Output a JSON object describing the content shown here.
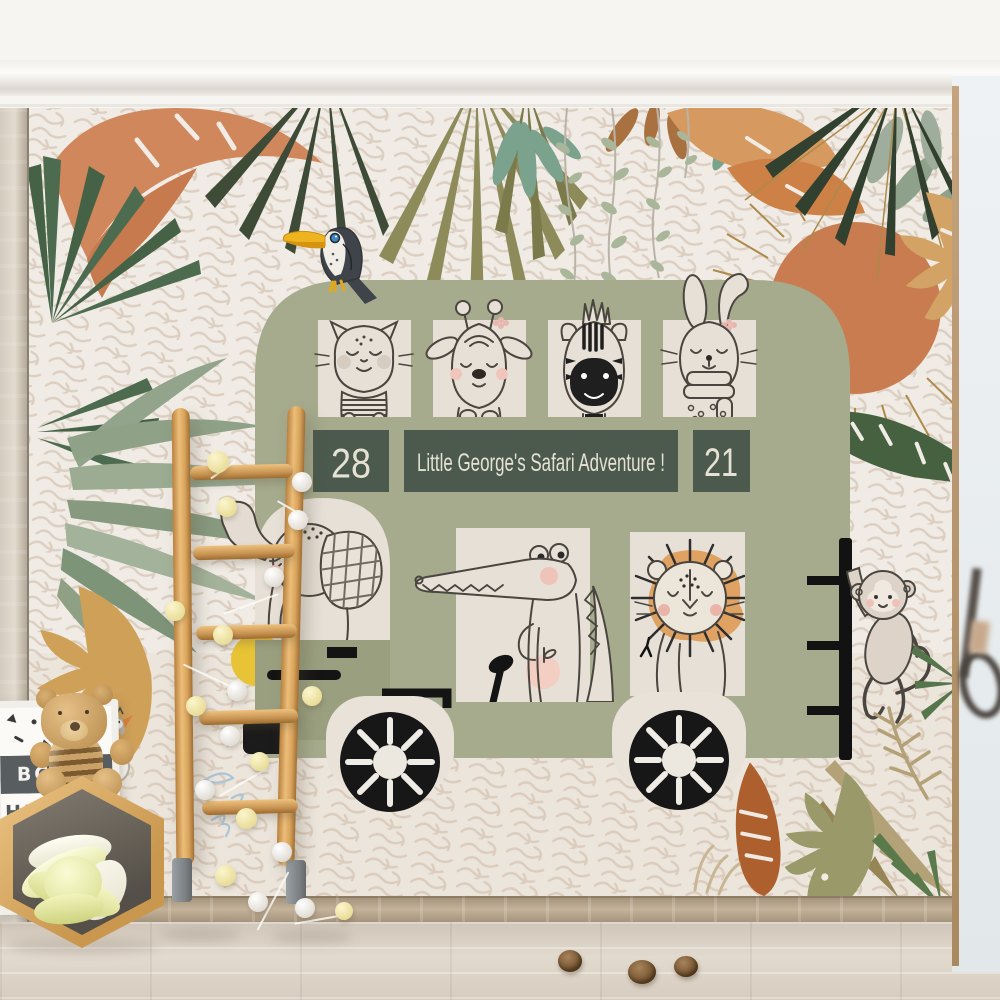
{
  "scene": {
    "bus": {
      "number_left": "28",
      "number_right": "21",
      "banner": "Little George's Safari Adventure !",
      "upper_window_animals": [
        "cat",
        "deer",
        "zebra",
        "rabbit"
      ],
      "driver": "elephant",
      "lower_window_animals": [
        "crocodile",
        "lion"
      ],
      "outside_animals": [
        "toucan",
        "monkey"
      ],
      "body_color": "#a6ab8d",
      "sign_color": "#4b5a4d",
      "window_color": "#e7e0d7",
      "wheel_color": "#171717"
    },
    "mural": {
      "wallpaper_base": "#f0ece5",
      "wallpaper_pattern": "#dccfc2",
      "sun_color": "#c87c50",
      "leaf_colors": [
        "#4d6b4f",
        "#8e8b5b",
        "#d0875c",
        "#93a48c",
        "#d2a364",
        "#ad5f2d",
        "#46613f",
        "#7aa28d"
      ]
    },
    "room": {
      "letter_board_rows": [
        "BCDE",
        "HIJKLM",
        "PQRST",
        "UVWXY"
      ],
      "objects": [
        "wooden-ladder",
        "pompom-garland",
        "teddy-bear",
        "hexagon-shelf",
        "knot-pillow",
        "letter-board",
        "pinecones",
        "swan-decal"
      ]
    }
  }
}
